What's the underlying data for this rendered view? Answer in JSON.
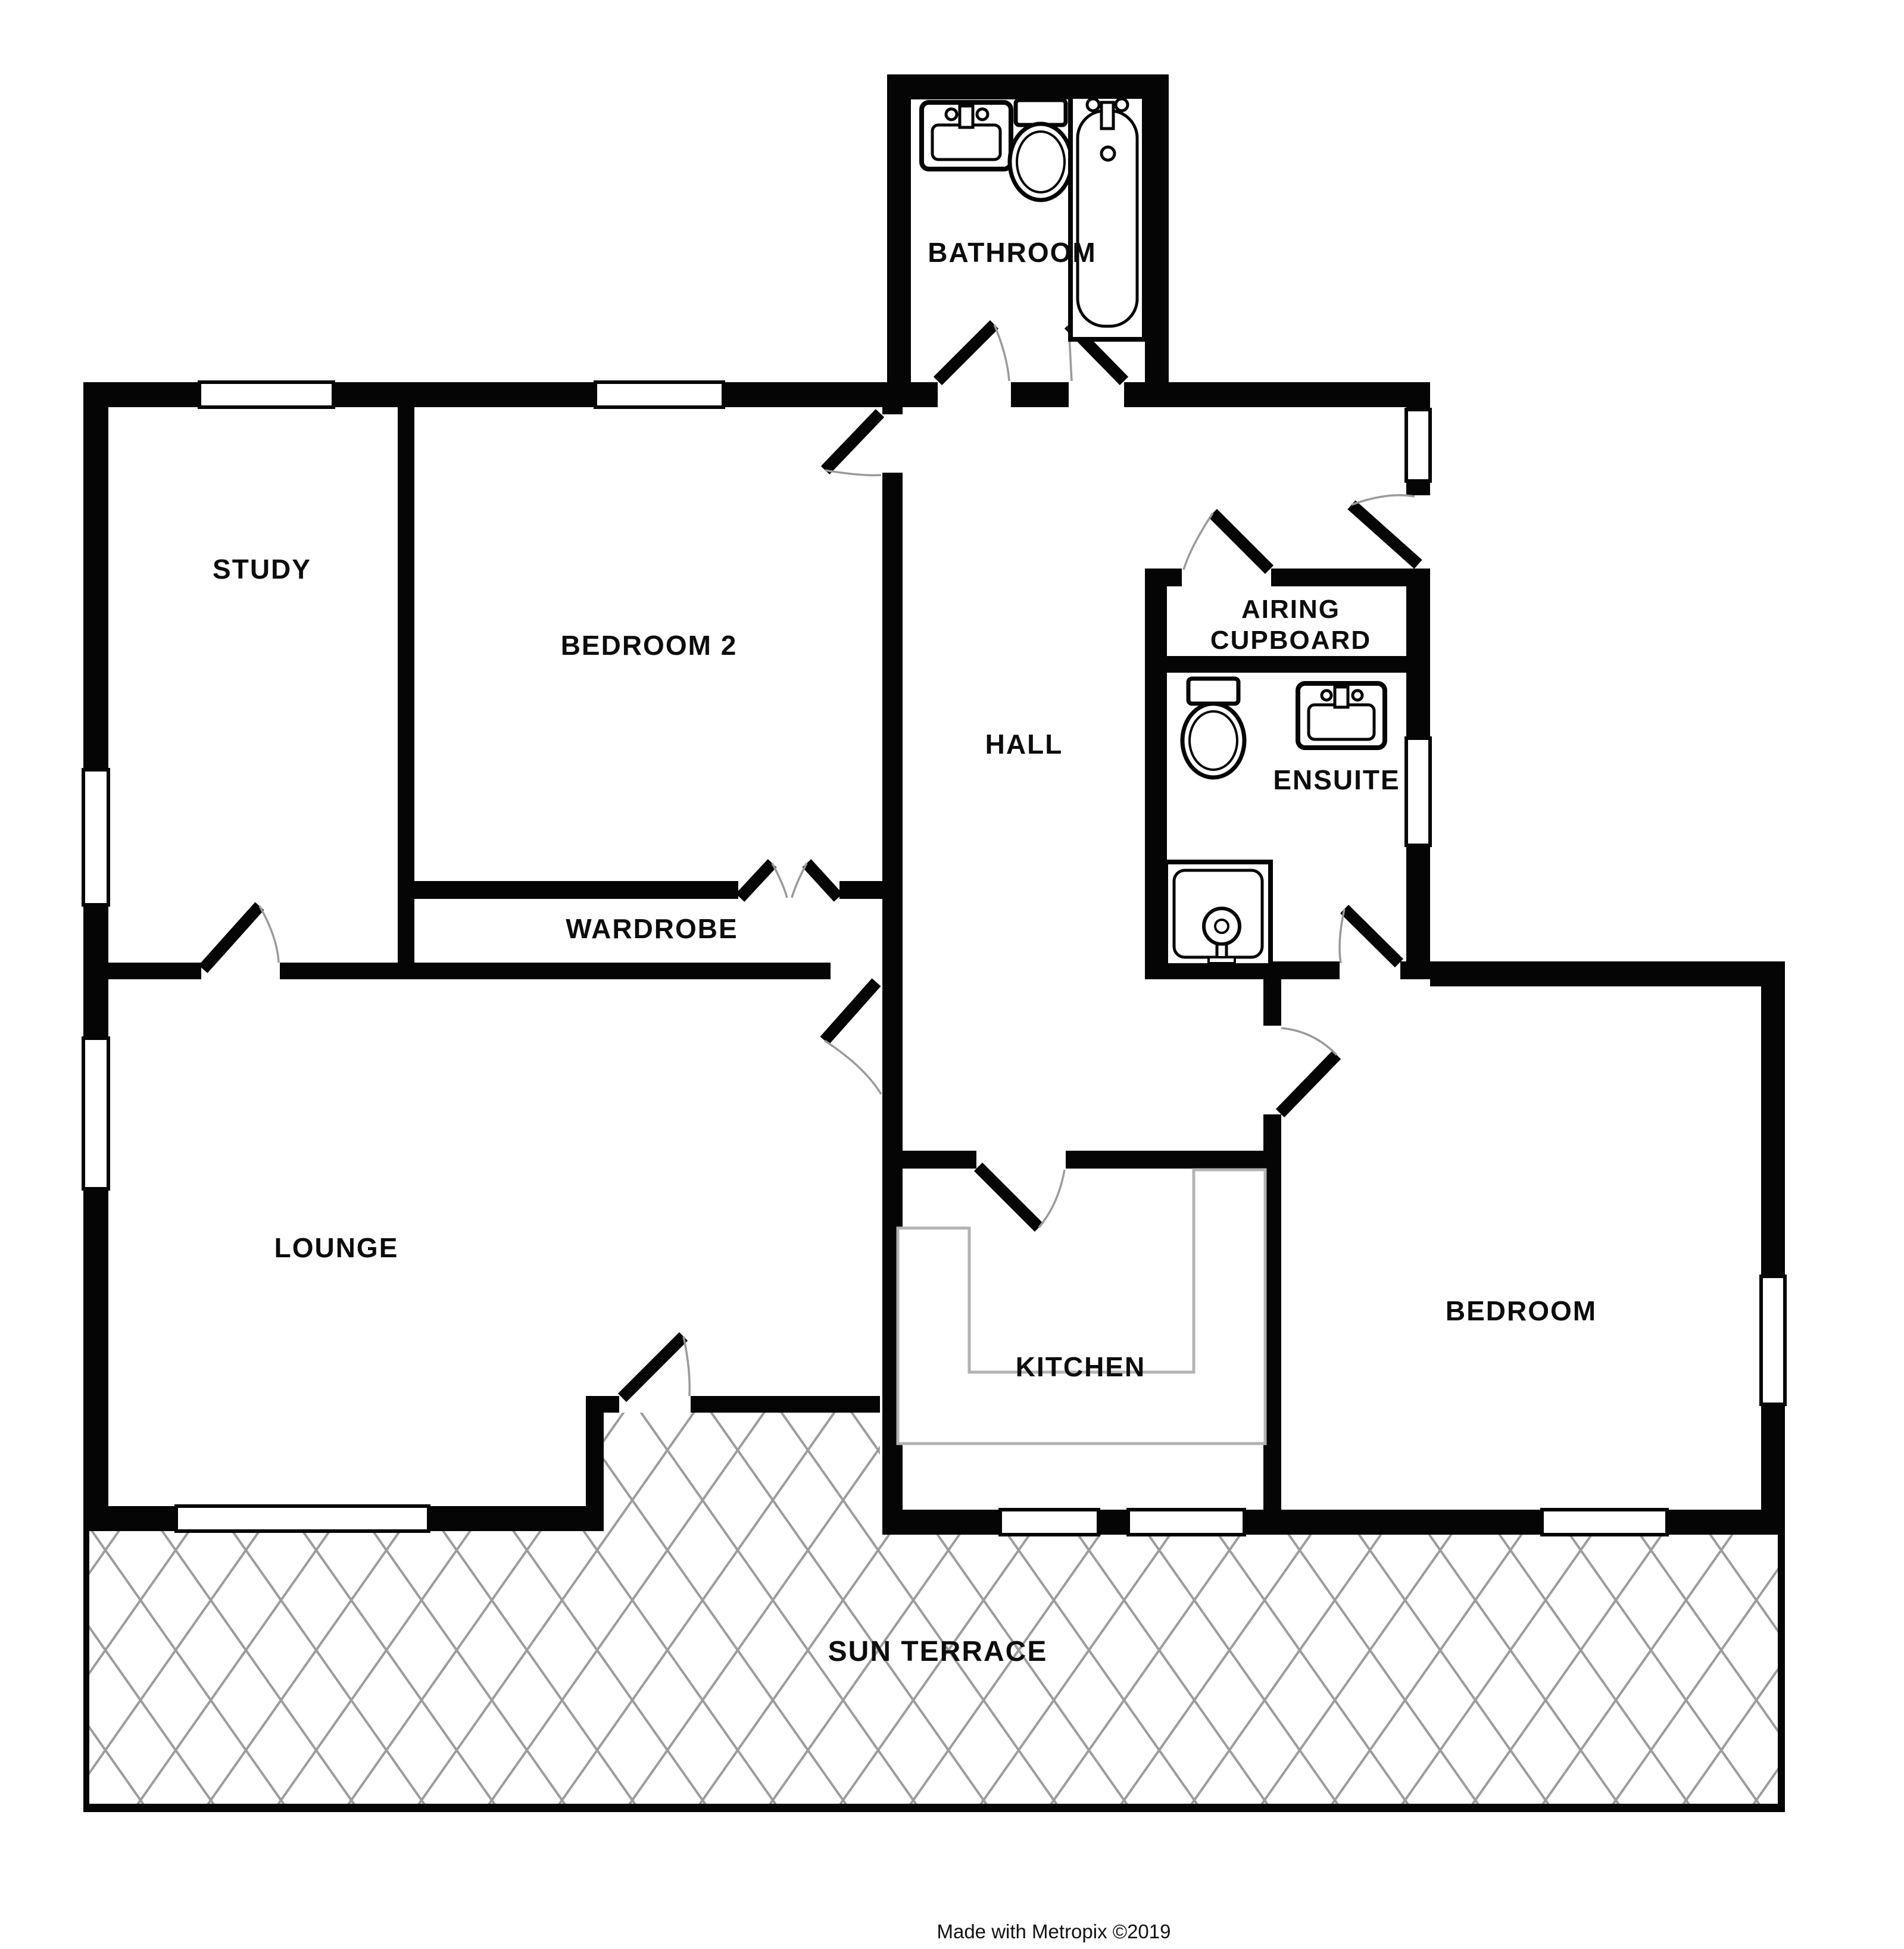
{
  "rooms": {
    "bathroom": {
      "label": "BATHROOM"
    },
    "study": {
      "label": "STUDY"
    },
    "bedroom2": {
      "label": "BEDROOM 2"
    },
    "hall": {
      "label": "HALL"
    },
    "airing_cupboard": {
      "label_line1": "AIRING",
      "label_line2": "CUPBOARD"
    },
    "ensuite": {
      "label": "ENSUITE"
    },
    "wardrobe": {
      "label": "WARDROBE"
    },
    "lounge": {
      "label": "LOUNGE"
    },
    "kitchen": {
      "label": "KITCHEN"
    },
    "bedroom": {
      "label": "BEDROOM"
    },
    "sun_terrace": {
      "label": "SUN TERRACE"
    }
  },
  "credit": {
    "text": "Made with Metropix ©2019"
  },
  "colors": {
    "wall": "#050505",
    "hatch": "#9c9c9c",
    "counter_outline": "#b3b3b3",
    "door_arc": "#9a9a9a",
    "background": "#ffffff"
  },
  "icons": [
    "bath-icon",
    "toilet-icon",
    "sink-icon",
    "shower-icon",
    "kitchen-counter-icon",
    "window-icon",
    "door-leaf-icon",
    "terrace-hatch-icon"
  ]
}
